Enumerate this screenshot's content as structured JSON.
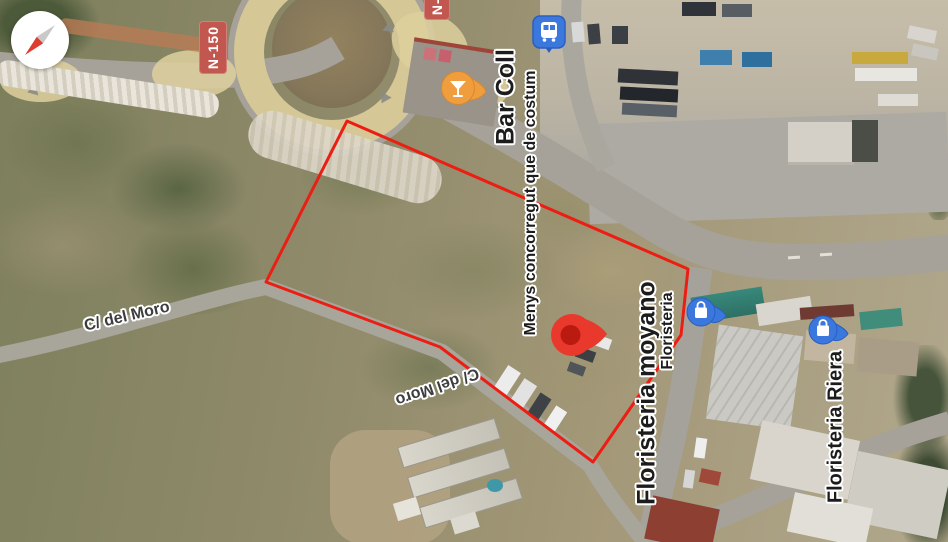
{
  "map": {
    "type": "satellite-map-view",
    "shields": {
      "n150": {
        "label": "N-150"
      },
      "n150_partial": {
        "label": "N-150"
      }
    },
    "roads": {
      "c_del_moro_left": "C/ del Moro",
      "c_del_moro_mid": "C/ del Moro"
    },
    "pois": {
      "bar_coll": {
        "label": "Bar Coll",
        "category": "bar"
      },
      "busy_status": {
        "label": "Menys concorregut que de costum"
      },
      "floristeria_moyano": {
        "label": "Floristeria moyano"
      },
      "floristeria": {
        "label": "Floristeria"
      },
      "floristeria_riera": {
        "label": "Floristeria Riera"
      }
    },
    "markers": {
      "red_pin": {
        "name": "selected-location-pin"
      },
      "bar_marker": {
        "name": "bar-drink-marker"
      },
      "shop_marker_1": {
        "name": "floristeria-shop-marker"
      },
      "shop_marker_2": {
        "name": "floristeria-riera-shop-marker"
      },
      "transit_marker": {
        "name": "transit-stop-marker"
      }
    },
    "parcel_outline": {
      "vertices": "347,121 688,269 681,335 593,462 440,347 266,282"
    },
    "colors": {
      "parcel_outline_red": "#ec1e13",
      "pin_red": "#e8392c",
      "pin_red_dark": "#bb1a10",
      "bar_marker_orange": "#f09d3d",
      "shop_marker_blue": "#3b78dd",
      "shield_red": "#c2574f",
      "label_halo": "#ffffff"
    }
  }
}
